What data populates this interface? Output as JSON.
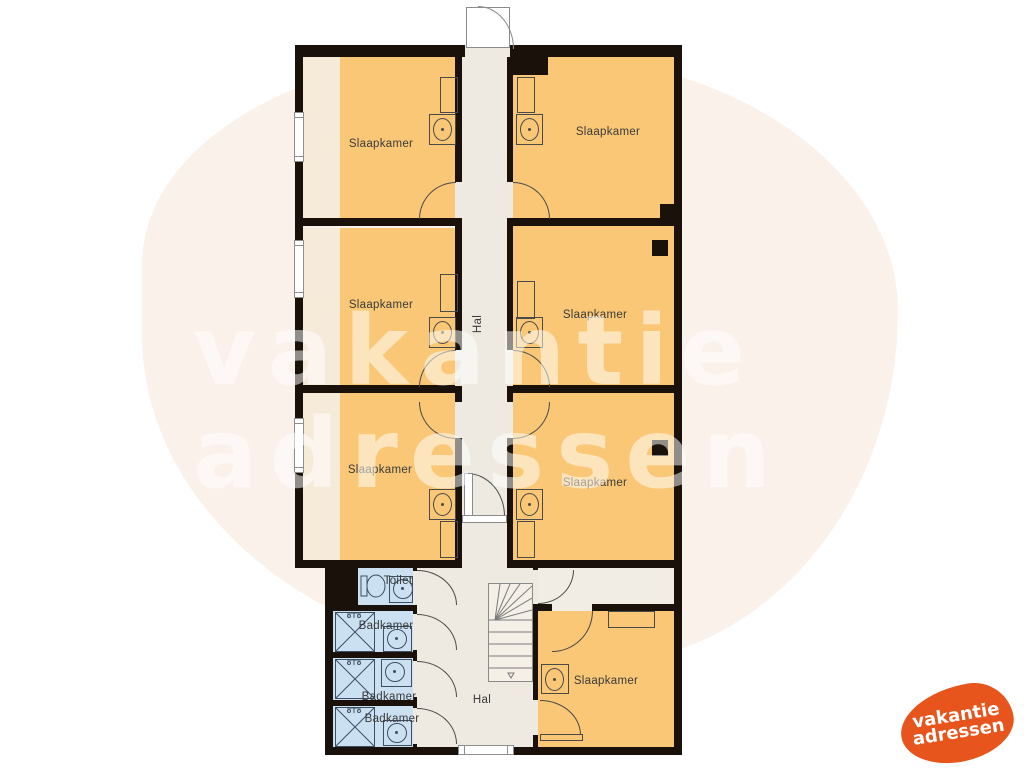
{
  "watermark": {
    "line1": "vakantie",
    "line2": "adressen"
  },
  "logo": {
    "line1": "vakantie",
    "line2": "adressen"
  },
  "colors": {
    "bedroom": "#f9c775",
    "bedroom_shade": "#f6ead9",
    "bathroom": "#cbe1f2",
    "hall": "#efeae1",
    "landing": "#f2ede4",
    "wall": "#1a120a",
    "watermark_blob": "#fbf1eb",
    "logo_orange": "#e7551c"
  },
  "rooms": {
    "bedrooms": [
      {
        "label": "Slaapkamer",
        "position": "top-left"
      },
      {
        "label": "Slaapkamer",
        "position": "top-right"
      },
      {
        "label": "Slaapkamer",
        "position": "middle-left"
      },
      {
        "label": "Slaapkamer",
        "position": "middle-right"
      },
      {
        "label": "Slaapkamer",
        "position": "lower-left"
      },
      {
        "label": "Slaapkamer",
        "position": "lower-right"
      },
      {
        "label": "Slaapkamer",
        "position": "bottom-right"
      }
    ],
    "halls": [
      {
        "label": "Hal",
        "position": "upper"
      },
      {
        "label": "Hal",
        "position": "lower"
      }
    ],
    "toilet": {
      "label": "Toilet"
    },
    "bathrooms": [
      {
        "label": "Badkamer"
      },
      {
        "label": "Badkamer"
      },
      {
        "label": "Badkamer"
      }
    ]
  }
}
